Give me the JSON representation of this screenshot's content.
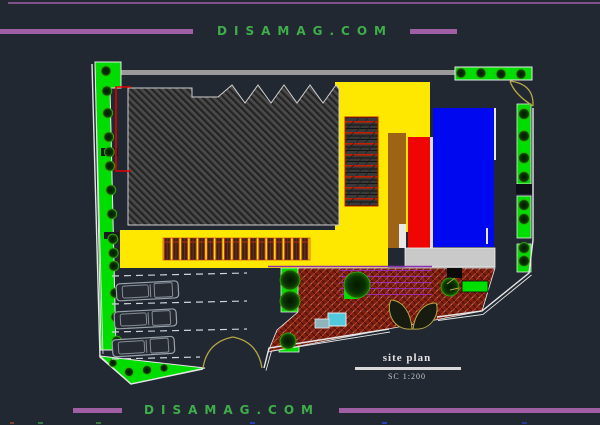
{
  "watermark": {
    "top": "DISAMAG.COM",
    "bottom": "DISAMAG.COM"
  },
  "title_block": {
    "title": "site plan",
    "scale": "SC 1:200"
  },
  "colors": {
    "background": "#212832",
    "divider_purple": "#a05fa5",
    "watermark_green": "#3fae4a",
    "lawn_green": "#00dd00",
    "building_yellow": "#ffe800",
    "block_blue": "#0008f0",
    "accent_red": "#f00505",
    "ramp_brown": "#9c6414",
    "paving_brick": "#7a1e10",
    "slab_gray": "#c9c9c9",
    "pool_cyan": "#52c8dc",
    "gate_olive": "#b5a642"
  }
}
